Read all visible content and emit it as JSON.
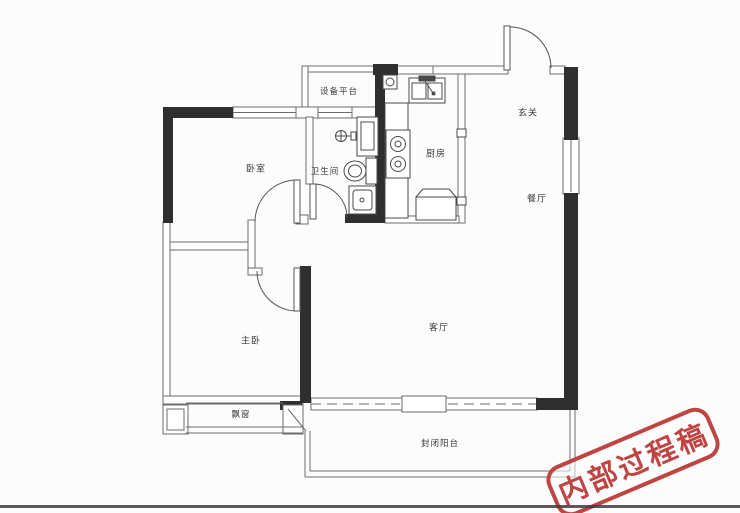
{
  "rooms": {
    "equipment_platform": {
      "label": "设备平台"
    },
    "bedroom": {
      "label": "卧室"
    },
    "bathroom": {
      "label": "卫生间"
    },
    "kitchen": {
      "label": "厨房"
    },
    "entry": {
      "label": "玄关"
    },
    "dining": {
      "label": "餐厅"
    },
    "master_bedroom": {
      "label": "主卧"
    },
    "living_room": {
      "label": "客厅"
    },
    "bay_window": {
      "label": "飘窗"
    },
    "balcony": {
      "label": "封闭阳台"
    }
  },
  "stamp": {
    "text": "内部过程稿",
    "color": "#bf4543",
    "rotation_deg": -23
  },
  "fixtures": [
    "entry-door",
    "bedroom-door",
    "master-bedroom-door",
    "bathroom-door",
    "toilet",
    "washbasin",
    "faucet",
    "shower-tray",
    "kitchen-sink",
    "stove",
    "fridge",
    "gas-meter",
    "window",
    "bay-window-glazing",
    "balcony-glazing"
  ],
  "colors": {
    "wall": "#2f2f2f",
    "thin_line": "#6b6b6b",
    "fixture_line": "#4a4a4a",
    "background": "#fcfcfc"
  }
}
